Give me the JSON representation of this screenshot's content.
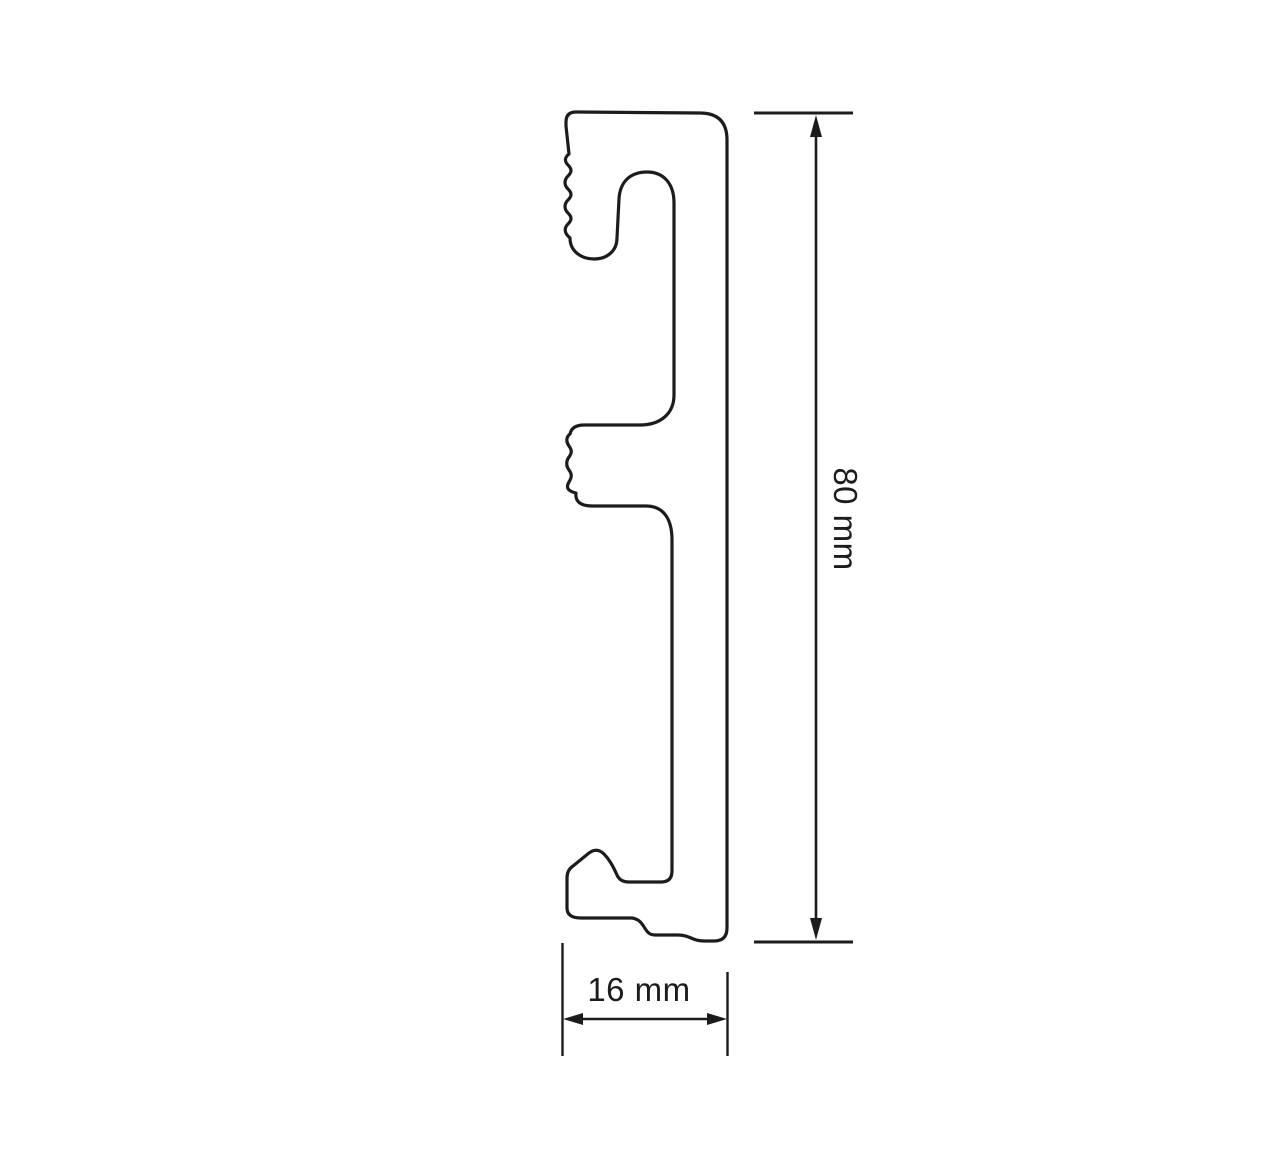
{
  "page": {
    "background_color": "#ffffff"
  },
  "drawing": {
    "colors": {
      "line": "#1c1c1c",
      "text": "#1c1c1c"
    },
    "dimensions": {
      "height": {
        "label": "80 mm",
        "value": 80,
        "unit": "mm",
        "orientation": "vertical"
      },
      "width": {
        "label": "16 mm",
        "value": 16,
        "unit": "mm",
        "orientation": "horizontal"
      }
    }
  }
}
